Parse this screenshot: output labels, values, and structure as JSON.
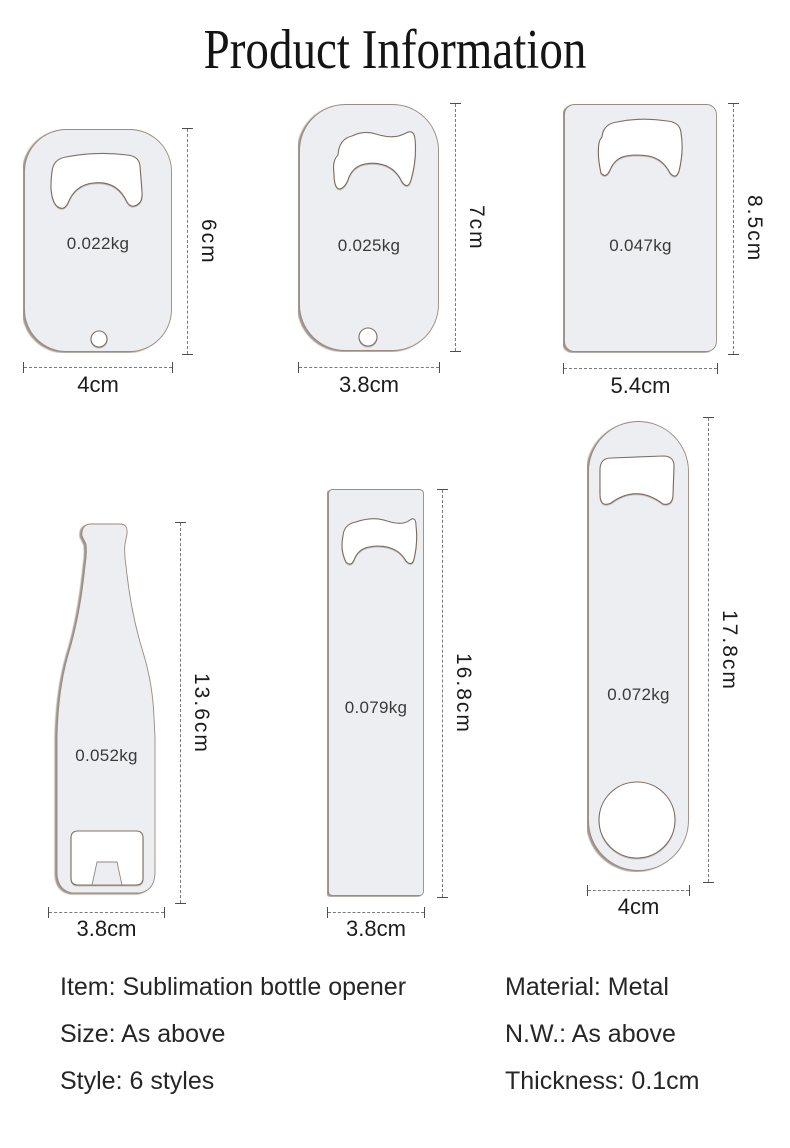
{
  "title": "Product Information",
  "openers": [
    {
      "shape": "dog-tag",
      "weight": "0.022kg",
      "height": "6cm",
      "width": "4cm"
    },
    {
      "shape": "rounded-tag",
      "weight": "0.025kg",
      "height": "7cm",
      "width": "3.8cm"
    },
    {
      "shape": "credit-card",
      "weight": "0.047kg",
      "height": "8.5cm",
      "width": "5.4cm"
    },
    {
      "shape": "bottle",
      "weight": "0.052kg",
      "height": "13.6cm",
      "width": "3.8cm"
    },
    {
      "shape": "flat-bar",
      "weight": "0.079kg",
      "height": "16.8cm",
      "width": "3.8cm"
    },
    {
      "shape": "speed-opener-paddle",
      "weight": "0.072kg",
      "height": "17.8cm",
      "width": "4cm"
    }
  ],
  "specs": {
    "left": [
      "Item: Sublimation bottle opener",
      "Size: As above",
      "Style: 6 styles"
    ],
    "right": [
      "Material: Metal",
      "N.W.: As above",
      "Thickness: 0.1cm"
    ]
  },
  "colors": {
    "background": "#ffffff",
    "opener_fill": "#eceef1",
    "cutout_fill": "#ffffff",
    "edge_line": "#6b5749",
    "dimension_line": "#4d4d4d",
    "text": "#262626"
  }
}
